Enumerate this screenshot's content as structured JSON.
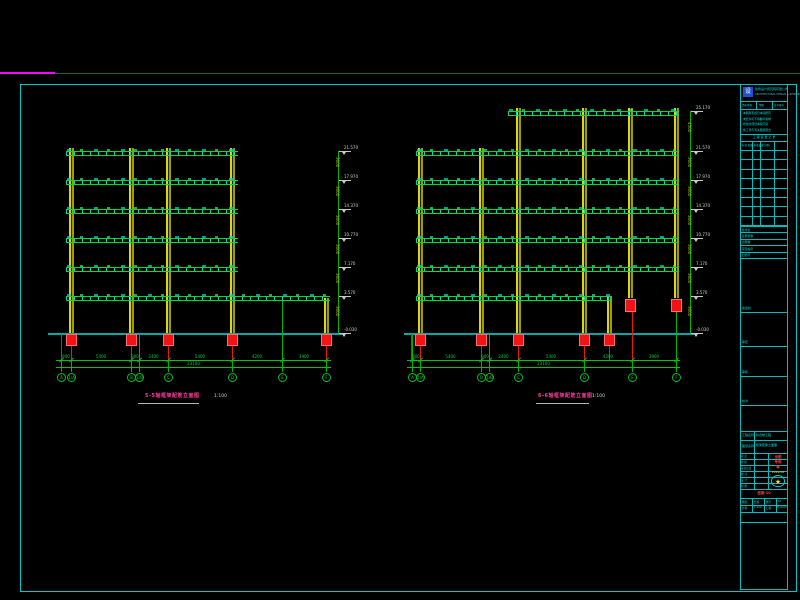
{
  "colors": {
    "background": "#000000",
    "frame_cyan": "#00c9c9",
    "beam_green": "#00dc32",
    "stirrup_cyan": "#00e1e1",
    "column_yellow": "#ddd900",
    "dimension_green": "#00c21e",
    "foundation_red": "#f21414",
    "ground_teal": "#00a8a8",
    "level_text_white": "#d2d2d2",
    "storey_text_olive": "#bdbd00",
    "title_magenta": "#ff3b9e",
    "titleblock_cyan": "#00e0e0",
    "logo_blue": "#1e4fd8",
    "stamp_red": "#ff3b3b",
    "seal_yellow": "#ffd23b",
    "top_trim_magenta": "#ff00ff",
    "top_trim_teal": "#11635a"
  },
  "drawing_titles": {
    "left": {
      "label": "5-5轴框架配筋立面图",
      "scale": "1:100"
    },
    "right": {
      "label": "6-6轴框架配筋立面图",
      "scale": "1:100"
    }
  },
  "elevations": [
    {
      "name": "left-frame-elevation",
      "columns": [
        {
          "x": 71,
          "y1": 148,
          "y2": 334
        },
        {
          "x": 131,
          "y1": 148,
          "y2": 334
        },
        {
          "x": 168,
          "y1": 148,
          "y2": 334
        },
        {
          "x": 232,
          "y1": 148,
          "y2": 334
        },
        {
          "x": 326,
          "y1": 298,
          "y2": 334
        }
      ],
      "beams": [
        {
          "y": 151,
          "x1": 66,
          "x2": 238
        },
        {
          "y": 180,
          "x1": 66,
          "x2": 238
        },
        {
          "y": 209,
          "x1": 66,
          "x2": 238
        },
        {
          "y": 238,
          "x1": 66,
          "x2": 238
        },
        {
          "y": 267,
          "x1": 66,
          "x2": 238
        },
        {
          "y": 296,
          "x1": 66,
          "x2": 330
        }
      ],
      "ground": {
        "y": 333,
        "x1": 48,
        "x2": 345
      },
      "red_blocks": [
        {
          "x": 71,
          "y": 334,
          "h": 12
        },
        {
          "x": 131,
          "y": 334,
          "h": 12
        },
        {
          "x": 168,
          "y": 334,
          "h": 12
        },
        {
          "x": 232,
          "y": 334,
          "h": 12
        },
        {
          "x": 326,
          "y": 334,
          "h": 12
        }
      ],
      "red_drops": [
        {
          "x": 61,
          "y1": 334,
          "y2": 361
        },
        {
          "x": 71,
          "y1": 346,
          "y2": 361
        },
        {
          "x": 131,
          "y1": 346,
          "y2": 361
        },
        {
          "x": 168,
          "y1": 346,
          "y2": 361
        },
        {
          "x": 232,
          "y1": 346,
          "y2": 361
        },
        {
          "x": 326,
          "y1": 346,
          "y2": 361
        }
      ],
      "grid_xs": [
        61,
        71,
        131,
        139,
        168,
        232,
        282,
        326
      ],
      "grid_y1": 334,
      "grid_y2": 372,
      "extra_lines": [
        {
          "x": 282,
          "y1": 301,
          "y2": 333
        }
      ],
      "dim": {
        "y1": 360,
        "y2": 367,
        "x1": 56,
        "x2": 331,
        "segments": [
          "900",
          "5400",
          "900",
          "2400",
          "5400",
          "4200",
          "3900"
        ],
        "total": "23100"
      },
      "bubbles": {
        "y": 377,
        "items": [
          {
            "x": 61,
            "label": "A"
          },
          {
            "x": 71,
            "label": "1/A"
          },
          {
            "x": 131,
            "label": "B"
          },
          {
            "x": 139,
            "label": "1/B"
          },
          {
            "x": 168,
            "label": "C"
          },
          {
            "x": 232,
            "label": "D"
          },
          {
            "x": 282,
            "label": "E"
          },
          {
            "x": 326,
            "label": "F"
          }
        ]
      },
      "level_line": {
        "x": 338,
        "storey": "3600",
        "levels": [
          {
            "y": 151,
            "value": "21.570"
          },
          {
            "y": 180,
            "value": "17.970"
          },
          {
            "y": 209,
            "value": "14.370"
          },
          {
            "y": 238,
            "value": "10.770"
          },
          {
            "y": 267,
            "value": "7.170"
          },
          {
            "y": 296,
            "value": "3.570"
          },
          {
            "y": 333,
            "value": "-0.030"
          }
        ]
      }
    },
    {
      "name": "right-frame-elevation",
      "columns": [
        {
          "x": 420,
          "y1": 148,
          "y2": 334
        },
        {
          "x": 481,
          "y1": 148,
          "y2": 334
        },
        {
          "x": 518,
          "y1": 108,
          "y2": 334
        },
        {
          "x": 584,
          "y1": 108,
          "y2": 334
        },
        {
          "x": 630,
          "y1": 108,
          "y2": 298
        },
        {
          "x": 676,
          "y1": 108,
          "y2": 298
        },
        {
          "x": 609,
          "y1": 296,
          "y2": 334
        }
      ],
      "beams": [
        {
          "y": 111,
          "x1": 508,
          "x2": 679
        },
        {
          "y": 151,
          "x1": 416,
          "x2": 679
        },
        {
          "y": 180,
          "x1": 416,
          "x2": 679
        },
        {
          "y": 209,
          "x1": 416,
          "x2": 679
        },
        {
          "y": 238,
          "x1": 416,
          "x2": 679
        },
        {
          "y": 267,
          "x1": 416,
          "x2": 679
        },
        {
          "y": 296,
          "x1": 416,
          "x2": 611
        }
      ],
      "ground": {
        "y": 333,
        "x1": 404,
        "x2": 695
      },
      "red_blocks": [
        {
          "x": 420,
          "y": 334,
          "h": 12
        },
        {
          "x": 481,
          "y": 334,
          "h": 12
        },
        {
          "x": 518,
          "y": 334,
          "h": 12
        },
        {
          "x": 584,
          "y": 334,
          "h": 12
        },
        {
          "x": 609,
          "y": 334,
          "h": 12
        },
        {
          "x": 630,
          "y": 299,
          "h": 13
        },
        {
          "x": 676,
          "y": 299,
          "h": 13
        }
      ],
      "red_drops": [
        {
          "x": 411,
          "y1": 334,
          "y2": 361
        },
        {
          "x": 420,
          "y1": 346,
          "y2": 361
        },
        {
          "x": 481,
          "y1": 346,
          "y2": 361
        },
        {
          "x": 518,
          "y1": 346,
          "y2": 361
        },
        {
          "x": 584,
          "y1": 346,
          "y2": 361
        },
        {
          "x": 609,
          "y1": 346,
          "y2": 361
        },
        {
          "x": 632,
          "y1": 312,
          "y2": 361
        }
      ],
      "grid_xs": [
        412,
        420,
        481,
        489,
        518,
        584,
        632,
        676
      ],
      "grid_y1": 334,
      "grid_y2": 372,
      "extra_lines": [
        {
          "x": 676,
          "y1": 312,
          "y2": 333
        }
      ],
      "dim": {
        "y1": 360,
        "y2": 367,
        "x1": 407,
        "x2": 680,
        "segments": [
          "900",
          "5400",
          "900",
          "2400",
          "5400",
          "4200",
          "3900"
        ],
        "total": "23100"
      },
      "bubbles": {
        "y": 377,
        "items": [
          {
            "x": 412,
            "label": "A"
          },
          {
            "x": 420,
            "label": "1/A"
          },
          {
            "x": 481,
            "label": "B"
          },
          {
            "x": 489,
            "label": "1/B"
          },
          {
            "x": 518,
            "label": "C"
          },
          {
            "x": 584,
            "label": "D"
          },
          {
            "x": 632,
            "label": "E"
          },
          {
            "x": 676,
            "label": "F"
          }
        ]
      },
      "level_line": {
        "x": 690,
        "storey": "3600",
        "top_storey": "4500",
        "levels": [
          {
            "y": 111,
            "value": "25.170"
          },
          {
            "y": 151,
            "value": "21.570"
          },
          {
            "y": 180,
            "value": "17.970"
          },
          {
            "y": 209,
            "value": "14.370"
          },
          {
            "y": 238,
            "value": "10.770"
          },
          {
            "y": 267,
            "value": "7.170"
          },
          {
            "y": 296,
            "value": "3.570"
          },
          {
            "y": 333,
            "value": "-0.030"
          }
        ]
      }
    }
  ],
  "title_block": {
    "logo_glyph": "设",
    "company": "建筑设计研究院有限公司",
    "company_en": "ARCHITECTURAL DESIGN & RESEARCH INSTITUTE",
    "cert_row": [
      "资质等级",
      "甲级",
      "证书编号"
    ],
    "notes": [
      "本图所有权归本院所有",
      "未经许可不得翻印复制",
      "修改时须经本院同意",
      "施工须与有关图纸配合"
    ],
    "rev_title": "工 程 变 更 记 录",
    "rev_cols": "标记 处数 修改依据 日期",
    "sign_rows": [
      "会签栏",
      "注册师章",
      "出图章",
      "项目编号",
      "归档号"
    ],
    "box_labels": [
      "会签栏",
      "审定",
      "审核",
      "校对"
    ],
    "project_label": "工程名称",
    "project_value": "综合楼工程",
    "sheet_label": "图纸名称",
    "sheet_value": "框架配筋立面图",
    "staff_rows": [
      "审 定",
      "审 核",
      "专业负责",
      "校 对",
      "设 计",
      "制 图"
    ],
    "stamp_lines": [
      "出图",
      "专用",
      "章"
    ],
    "stamp_note": "2019.06",
    "badge_star": "★",
    "doc_no_red": "结施-10",
    "bottom_rows": [
      [
        "图别",
        "结施"
      ],
      [
        "图号",
        "10"
      ],
      [
        "比例",
        "1:100"
      ],
      [
        "日期",
        "2019.06"
      ]
    ]
  }
}
